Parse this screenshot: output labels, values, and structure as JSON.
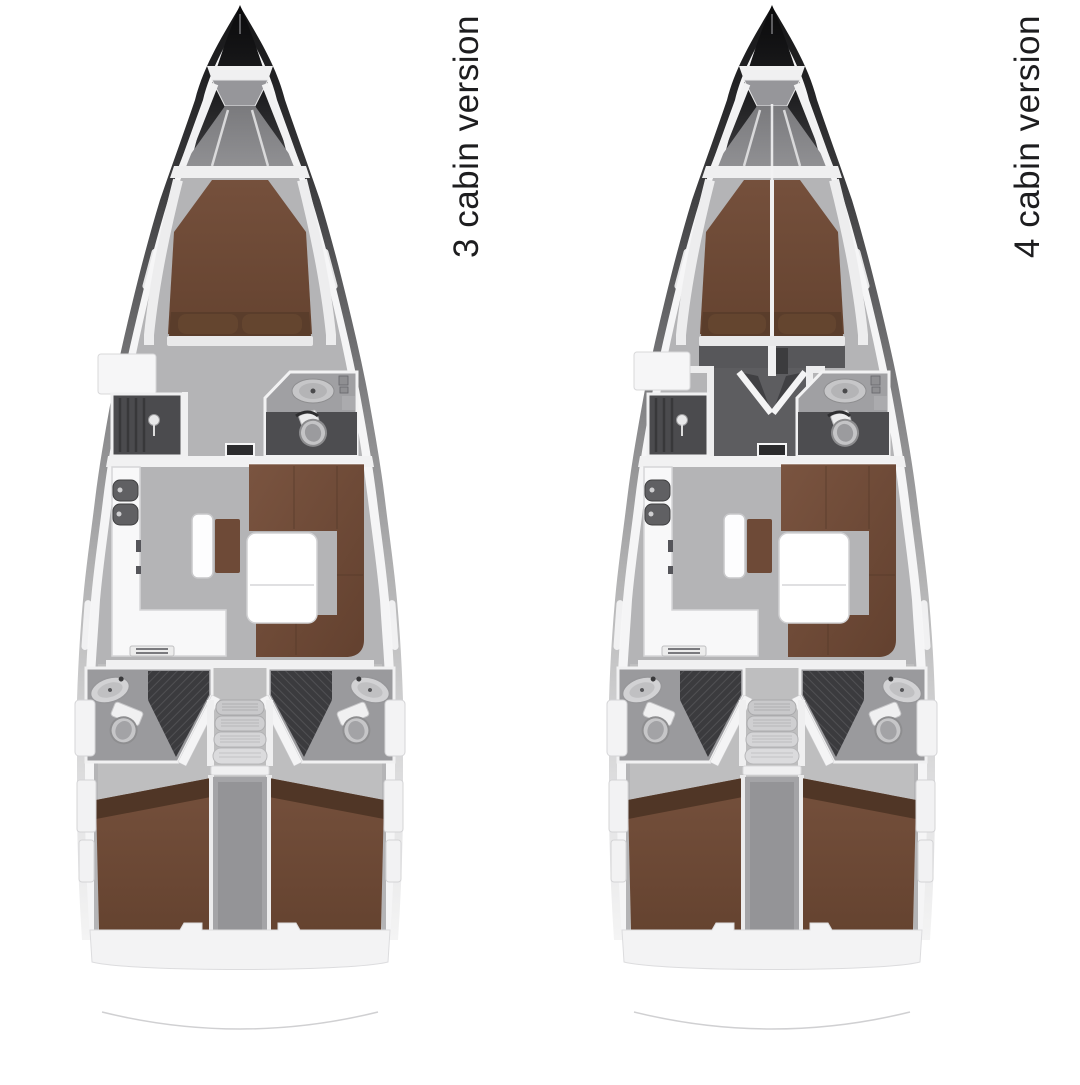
{
  "boats": [
    {
      "id": "three-cabin",
      "label": "3 cabin version",
      "cabins": 3,
      "regions": [
        "anchor-locker",
        "foredeck",
        "owner-forward-cabin",
        "dressing-area",
        "shower-room",
        "forward-head",
        "saloon",
        "galley",
        "nav-seat",
        "u-sofa",
        "saloon-table",
        "companionway-steps",
        "port-aft-head",
        "starboard-aft-head",
        "port-aft-cabin",
        "starboard-aft-cabin",
        "engine-compartment",
        "transom"
      ]
    },
    {
      "id": "four-cabin",
      "label": "4 cabin version",
      "cabins": 4,
      "regions": [
        "anchor-locker",
        "foredeck",
        "port-forward-cabin",
        "starboard-forward-cabin",
        "forward-corridor",
        "shower-room",
        "forward-head",
        "saloon",
        "galley",
        "nav-seat",
        "u-sofa",
        "saloon-table",
        "companionway-steps",
        "port-aft-head",
        "starboard-aft-head",
        "port-aft-cabin",
        "starboard-aft-cabin",
        "engine-compartment",
        "transom"
      ]
    }
  ],
  "colors": {
    "background": "#ffffff",
    "hull_dark": "#141416",
    "deck_white": "#f5f5f6",
    "floor_gray": "#b4b4b6",
    "floor_aft": "#c6c6c7",
    "wall_white": "#f0f0f1",
    "dark_room": "#4b4b4e",
    "corridor_dark": "#5d5d60",
    "upholstery_brown": "#6f4b37",
    "upholstery_dark": "#533827",
    "fixture_gray": "#c6c6c8",
    "shower_grid": "#3a3a3c",
    "step_gray": "#d5d5d7",
    "label_text": "#1d1d1f"
  }
}
